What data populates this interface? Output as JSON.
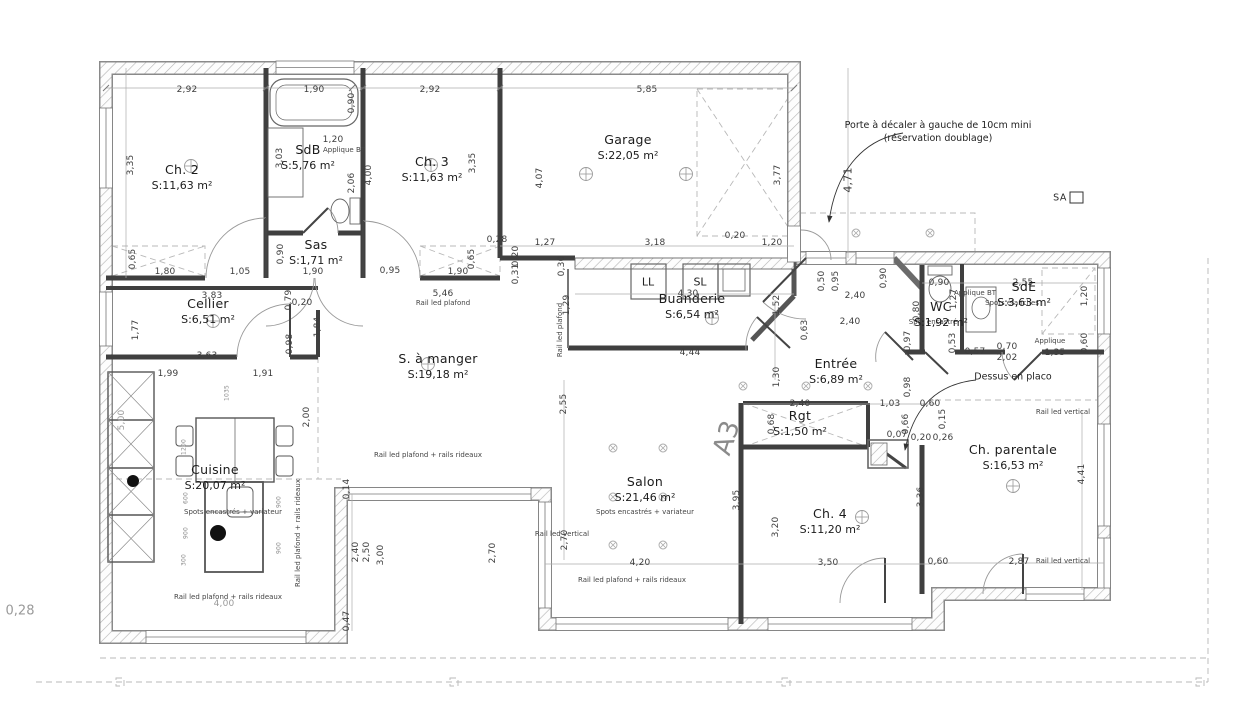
{
  "annotations": {
    "door_note_line1": "Porte à décaler à gauche de 10cm mini",
    "door_note_line2": "(réservation doublage)",
    "sheet_ref": "SA",
    "section_ref": "A3",
    "margin_dim": "0,28"
  },
  "rooms": [
    {
      "name": "Ch. 2",
      "area": "S:11,63 m²",
      "x": 182,
      "y": 178
    },
    {
      "name": "SdB",
      "area": "S:5,76 m²",
      "x": 308,
      "y": 158
    },
    {
      "name": "Ch. 3",
      "area": "S:11,63 m²",
      "x": 432,
      "y": 170
    },
    {
      "name": "Sas",
      "area": "S:1,71 m²",
      "x": 316,
      "y": 253
    },
    {
      "name": "Garage",
      "area": "S:22,05 m²",
      "x": 628,
      "y": 148
    },
    {
      "name": "Cellier",
      "area": "S:6,51 m²",
      "x": 208,
      "y": 312
    },
    {
      "name": "Buanderie",
      "area": "S:6,54 m²",
      "x": 692,
      "y": 307
    },
    {
      "name": "S. à manger",
      "area": "S:19,18 m²",
      "x": 438,
      "y": 367
    },
    {
      "name": "Cuisine",
      "area": "S:20,07 m²",
      "x": 215,
      "y": 478
    },
    {
      "name": "Entrée",
      "area": "S:6,89 m²",
      "x": 836,
      "y": 372
    },
    {
      "name": "WC",
      "area": "S:1,92 m²",
      "x": 941,
      "y": 315
    },
    {
      "name": "SdE",
      "area": "S:3,63 m²",
      "x": 1024,
      "y": 295
    },
    {
      "name": "Salon",
      "area": "S:21,46 m²",
      "x": 645,
      "y": 490
    },
    {
      "name": "Rgt",
      "area": "S:1,50 m²",
      "x": 800,
      "y": 424
    },
    {
      "name": "Ch. 4",
      "area": "S:11,20 m²",
      "x": 830,
      "y": 522
    },
    {
      "name": "Ch. parentale",
      "area": "S:16,53 m²",
      "x": 1013,
      "y": 458
    }
  ],
  "dimensions": [
    {
      "t": "2,92",
      "x": 187,
      "y": 90
    },
    {
      "t": "1,90",
      "x": 314,
      "y": 90
    },
    {
      "t": "0,90",
      "x": 352,
      "y": 103,
      "r": 1
    },
    {
      "t": "2,92",
      "x": 430,
      "y": 90
    },
    {
      "t": "5,85",
      "x": 647,
      "y": 90
    },
    {
      "t": "3,35",
      "x": 131,
      "y": 165,
      "r": 1
    },
    {
      "t": "3,03",
      "x": 280,
      "y": 158,
      "r": 1
    },
    {
      "t": "1,20",
      "x": 333,
      "y": 140
    },
    {
      "t": "2,06",
      "x": 352,
      "y": 183,
      "r": 1
    },
    {
      "t": "4,00",
      "x": 369,
      "y": 175,
      "r": 1
    },
    {
      "t": "3,35",
      "x": 473,
      "y": 163,
      "r": 1
    },
    {
      "t": "4,07",
      "x": 540,
      "y": 178,
      "r": 1
    },
    {
      "t": "3,77",
      "x": 778,
      "y": 175,
      "r": 1
    },
    {
      "t": "4,71",
      "x": 848,
      "y": 180,
      "r": 1,
      "c": "dim md"
    },
    {
      "t": "0,65",
      "x": 133,
      "y": 259,
      "r": 1
    },
    {
      "t": "1,80",
      "x": 165,
      "y": 272
    },
    {
      "t": "1,05",
      "x": 240,
      "y": 272
    },
    {
      "t": "0,90",
      "x": 281,
      "y": 254,
      "r": 1
    },
    {
      "t": "1,90",
      "x": 313,
      "y": 272
    },
    {
      "t": "0,95",
      "x": 390,
      "y": 271
    },
    {
      "t": "1,90",
      "x": 458,
      "y": 272
    },
    {
      "t": "0,65",
      "x": 472,
      "y": 259,
      "r": 1
    },
    {
      "t": "0,28",
      "x": 497,
      "y": 240
    },
    {
      "t": "0,20",
      "x": 516,
      "y": 256,
      "r": 1
    },
    {
      "t": "0,31",
      "x": 516,
      "y": 274,
      "r": 1
    },
    {
      "t": "0,30",
      "x": 562,
      "y": 266,
      "r": 1
    },
    {
      "t": "1,27",
      "x": 545,
      "y": 243
    },
    {
      "t": "3,18",
      "x": 655,
      "y": 243
    },
    {
      "t": "0,20",
      "x": 735,
      "y": 236
    },
    {
      "t": "1,20",
      "x": 772,
      "y": 243
    },
    {
      "t": "0,50",
      "x": 822,
      "y": 281,
      "r": 1
    },
    {
      "t": "0,95",
      "x": 836,
      "y": 281,
      "r": 1
    },
    {
      "t": "0,90",
      "x": 884,
      "y": 278,
      "r": 1
    },
    {
      "t": "2,40",
      "x": 855,
      "y": 296
    },
    {
      "t": "2,40",
      "x": 850,
      "y": 322
    },
    {
      "t": "LL",
      "x": 648,
      "y": 282,
      "c": "eq"
    },
    {
      "t": "SL",
      "x": 700,
      "y": 282,
      "c": "eq"
    },
    {
      "t": "4,30",
      "x": 688,
      "y": 294
    },
    {
      "t": "1,52",
      "x": 777,
      "y": 305,
      "r": 1
    },
    {
      "t": "0,63",
      "x": 805,
      "y": 330,
      "r": 1
    },
    {
      "t": "4,44",
      "x": 690,
      "y": 353
    },
    {
      "t": "1,29",
      "x": 567,
      "y": 305,
      "r": 1
    },
    {
      "t": "5,46",
      "x": 443,
      "y": 294
    },
    {
      "t": "3,83",
      "x": 212,
      "y": 296
    },
    {
      "t": "0,79",
      "x": 289,
      "y": 300,
      "r": 1
    },
    {
      "t": "0,20",
      "x": 302,
      "y": 303
    },
    {
      "t": "0,98",
      "x": 290,
      "y": 344,
      "r": 1
    },
    {
      "t": "1,84",
      "x": 318,
      "y": 327,
      "r": 1
    },
    {
      "t": "3,63",
      "x": 207,
      "y": 356
    },
    {
      "t": "1,77",
      "x": 136,
      "y": 330,
      "r": 1
    },
    {
      "t": "1,99",
      "x": 168,
      "y": 374
    },
    {
      "t": "1,91",
      "x": 263,
      "y": 374
    },
    {
      "t": "2,00",
      "x": 307,
      "y": 417,
      "r": 1
    },
    {
      "t": "2,55",
      "x": 564,
      "y": 404,
      "r": 1
    },
    {
      "t": "1,30",
      "x": 777,
      "y": 377,
      "r": 1
    },
    {
      "t": "2,40",
      "x": 800,
      "y": 404
    },
    {
      "t": "1,03",
      "x": 890,
      "y": 404
    },
    {
      "t": "0,60",
      "x": 930,
      "y": 404
    },
    {
      "t": "0,68",
      "x": 772,
      "y": 424,
      "r": 1
    },
    {
      "t": "0,66",
      "x": 906,
      "y": 424,
      "r": 1
    },
    {
      "t": "0,15",
      "x": 943,
      "y": 419,
      "r": 1
    },
    {
      "t": "0,07",
      "x": 897,
      "y": 435
    },
    {
      "t": "0,20",
      "x": 921,
      "y": 438
    },
    {
      "t": "0,26",
      "x": 943,
      "y": 438
    },
    {
      "t": "0,98",
      "x": 908,
      "y": 387,
      "r": 1
    },
    {
      "t": "0,97",
      "x": 908,
      "y": 341,
      "r": 1
    },
    {
      "t": "0,90",
      "x": 939,
      "y": 283
    },
    {
      "t": "2,55",
      "x": 1023,
      "y": 283
    },
    {
      "t": "1,27",
      "x": 954,
      "y": 299,
      "r": 1
    },
    {
      "t": "0,80",
      "x": 917,
      "y": 311,
      "r": 1
    },
    {
      "t": "1,20",
      "x": 1085,
      "y": 296,
      "r": 1
    },
    {
      "t": "0,53",
      "x": 953,
      "y": 343,
      "r": 1
    },
    {
      "t": "0,57",
      "x": 975,
      "y": 352
    },
    {
      "t": "0,70",
      "x": 1007,
      "y": 347
    },
    {
      "t": "2,02",
      "x": 1007,
      "y": 358
    },
    {
      "t": "1,35",
      "x": 1055,
      "y": 353
    },
    {
      "t": "0,60",
      "x": 1085,
      "y": 343,
      "r": 1
    },
    {
      "t": "4,41",
      "x": 1082,
      "y": 474,
      "r": 1
    },
    {
      "t": "2,87",
      "x": 1019,
      "y": 562
    },
    {
      "t": "0,60",
      "x": 938,
      "y": 562
    },
    {
      "t": "3,36",
      "x": 921,
      "y": 497,
      "r": 1
    },
    {
      "t": "3,20",
      "x": 776,
      "y": 527,
      "r": 1
    },
    {
      "t": "3,95",
      "x": 737,
      "y": 500,
      "r": 1
    },
    {
      "t": "4,20",
      "x": 640,
      "y": 563
    },
    {
      "t": "3,50",
      "x": 828,
      "y": 563
    },
    {
      "t": "2,70",
      "x": 565,
      "y": 540,
      "r": 1
    },
    {
      "t": "2,70",
      "x": 493,
      "y": 553,
      "r": 1
    },
    {
      "t": "0,14",
      "x": 347,
      "y": 489,
      "r": 1
    },
    {
      "t": "2,40",
      "x": 356,
      "y": 552,
      "r": 1
    },
    {
      "t": "2,50",
      "x": 367,
      "y": 552,
      "r": 1
    },
    {
      "t": "3,00",
      "x": 381,
      "y": 555,
      "r": 1
    },
    {
      "t": "0,47",
      "x": 347,
      "y": 621,
      "r": 1
    },
    {
      "t": "5,00",
      "x": 122,
      "y": 420,
      "r": 1,
      "c": "dim g"
    },
    {
      "t": "4,00",
      "x": 224,
      "y": 604,
      "c": "dim g"
    },
    {
      "t": "1035",
      "x": 227,
      "y": 393,
      "r": 1,
      "c": "dim mm"
    },
    {
      "t": "1200",
      "x": 184,
      "y": 447,
      "r": 1,
      "c": "dim mm"
    },
    {
      "t": "600",
      "x": 186,
      "y": 498,
      "r": 1,
      "c": "dim mm"
    },
    {
      "t": "900",
      "x": 186,
      "y": 533,
      "r": 1,
      "c": "dim mm"
    },
    {
      "t": "300",
      "x": 184,
      "y": 560,
      "r": 1,
      "c": "dim mm"
    },
    {
      "t": "900",
      "x": 279,
      "y": 502,
      "r": 1,
      "c": "dim mm"
    },
    {
      "t": "900",
      "x": 279,
      "y": 548,
      "r": 1,
      "c": "dim mm"
    }
  ],
  "notes": [
    {
      "t": "Rail led plafond",
      "x": 443,
      "y": 303
    },
    {
      "t": "Rail led plafond",
      "x": 560,
      "y": 330,
      "r": 1
    },
    {
      "t": "Rail led plafond + rails rideaux",
      "x": 428,
      "y": 455
    },
    {
      "t": "Rail led plafond + rails rideaux",
      "x": 632,
      "y": 580
    },
    {
      "t": "Rail led plafond + rails rideaux",
      "x": 228,
      "y": 597
    },
    {
      "t": "Rail led plafond + rails rideaux",
      "x": 298,
      "y": 533,
      "r": 1
    },
    {
      "t": "Rail led vertical",
      "x": 562,
      "y": 534
    },
    {
      "t": "Rail led vertical",
      "x": 1063,
      "y": 412
    },
    {
      "t": "Rail led vertical",
      "x": 1063,
      "y": 561
    },
    {
      "t": "Spots encastrés + variateur",
      "x": 645,
      "y": 512
    },
    {
      "t": "Spots encastrés + variateur",
      "x": 233,
      "y": 512
    },
    {
      "t": "Spots étanches",
      "x": 1012,
      "y": 303
    },
    {
      "t": "Spot encastré",
      "x": 933,
      "y": 322
    },
    {
      "t": "Applique BT",
      "x": 344,
      "y": 150
    },
    {
      "t": "Applique BT",
      "x": 975,
      "y": 293
    },
    {
      "t": "Applique",
      "x": 1050,
      "y": 341
    },
    {
      "t": "Dessus en placo",
      "x": 1013,
      "y": 378,
      "c": "note2"
    }
  ]
}
